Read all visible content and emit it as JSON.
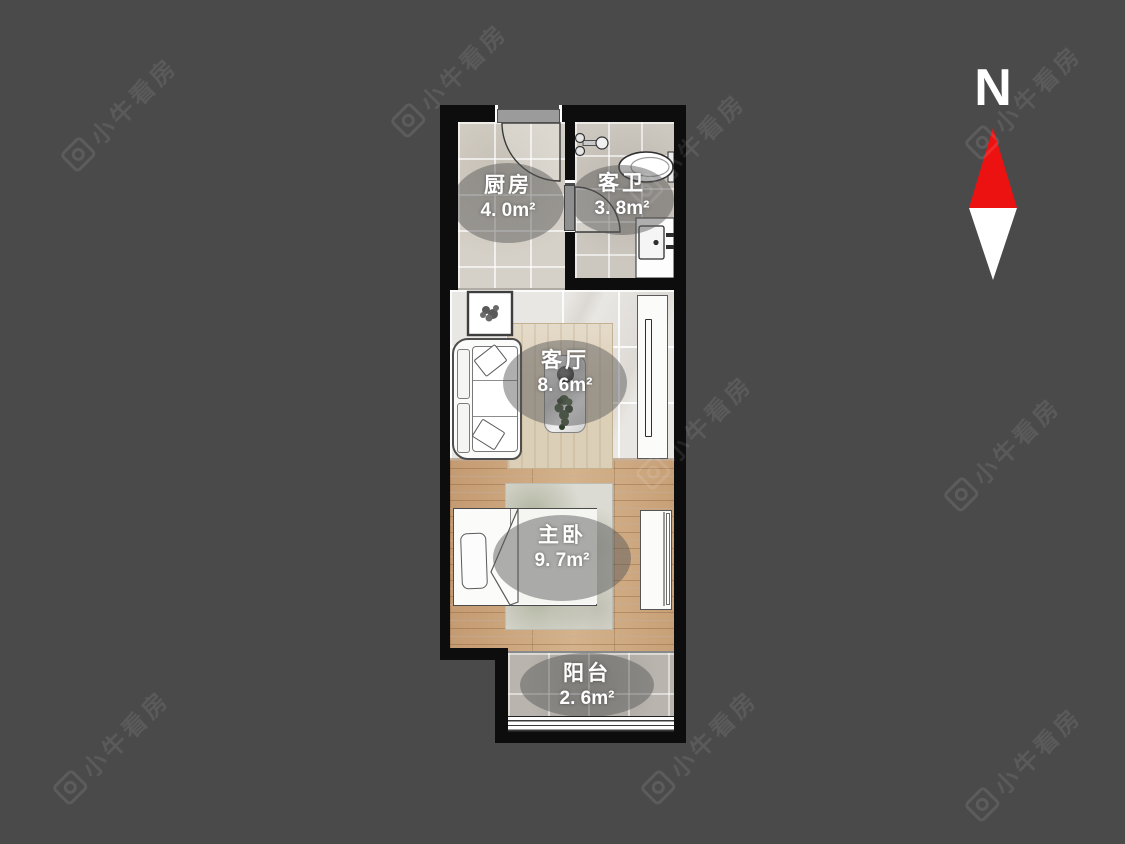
{
  "page": {
    "background": "#4a4a4b"
  },
  "compass": {
    "label": "N",
    "arrow_red": "#ec1212",
    "arrow_white": "#ffffff"
  },
  "watermark": {
    "text": "小牛看房",
    "logo": "camera-icon"
  },
  "rooms": [
    {
      "key": "kitchen",
      "name": "厨房",
      "area": "4. 0m²"
    },
    {
      "key": "bathroom",
      "name": "客卫",
      "area": "3. 8m²"
    },
    {
      "key": "living_room",
      "name": "客厅",
      "area": "8. 6m²"
    },
    {
      "key": "master_bedroom",
      "name": "主卧",
      "area": "9. 7m²"
    },
    {
      "key": "balcony",
      "name": "阳台",
      "area": "2. 6m²"
    }
  ],
  "fixtures": [
    "entrance-door",
    "bathroom-door",
    "faucet",
    "toilet",
    "washbasin",
    "picture-frame",
    "sofa",
    "living-rug",
    "coffee-table",
    "plant",
    "tv-cabinet",
    "bed",
    "bedroom-rug",
    "wardrobe",
    "balcony-window"
  ],
  "colors": {
    "wall": "#0d0d0d",
    "kitchen_floor": "#d6d1c8",
    "bath_floor": "#ccc7bf",
    "living_floor": "#e9e7e3",
    "bedroom_floor": "#cba57e",
    "balcony_floor": "#b9b5ae",
    "label_bubble": "rgba(88,88,88,0.48)"
  }
}
